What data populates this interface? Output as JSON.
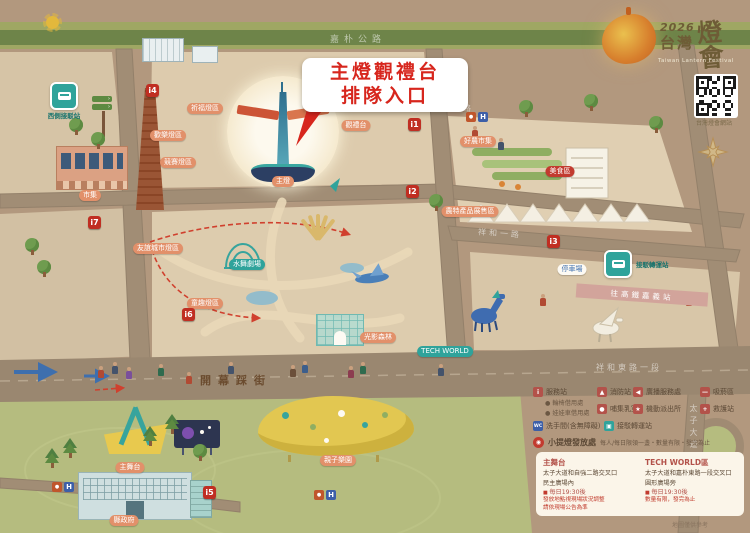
{
  "logo": {
    "year": "2026",
    "title_zh": "台灣",
    "title_cal": "燈會",
    "title_en": "Taiwan Lantern Festival",
    "qr_caption": "台灣燈會網站"
  },
  "callout": {
    "line1": "主燈觀禮台",
    "line2": "排隊入口"
  },
  "roads": {
    "top": "嘉朴公路",
    "market_top": "祥和二路",
    "market_bottom": "祥和一路",
    "east": "祥和東路一段",
    "parade": "開幕踩街",
    "south": "太子大道"
  },
  "badges": {
    "west_shuttle": "西側接駁站",
    "east_shuttle": "接駁轉運站",
    "hsr": "往高鐵嘉義站"
  },
  "markers": [
    {
      "id": "i1",
      "x": 408,
      "y": 118
    },
    {
      "id": "i2",
      "x": 406,
      "y": 185
    },
    {
      "id": "i3",
      "x": 547,
      "y": 235
    },
    {
      "id": "i4",
      "x": 146,
      "y": 84
    },
    {
      "id": "i5",
      "x": 203,
      "y": 486
    },
    {
      "id": "i6",
      "x": 182,
      "y": 308
    },
    {
      "id": "i7",
      "x": 88,
      "y": 216
    }
  ],
  "h_badges": [
    {
      "x": 466,
      "y": 112
    },
    {
      "x": 52,
      "y": 482
    },
    {
      "x": 314,
      "y": 490
    }
  ],
  "zones": [
    {
      "label": "祈福燈區",
      "x": 205,
      "y": 103,
      "c": "orange"
    },
    {
      "label": "歡樂燈區",
      "x": 168,
      "y": 130,
      "c": "orange"
    },
    {
      "label": "競賽燈區",
      "x": 178,
      "y": 157,
      "c": "orange"
    },
    {
      "label": "友誼城市燈區",
      "x": 158,
      "y": 243,
      "c": "orange"
    },
    {
      "label": "童趣燈區",
      "x": 205,
      "y": 298,
      "c": "orange"
    },
    {
      "label": "水舞劇場",
      "x": 247,
      "y": 259,
      "c": "teal"
    },
    {
      "label": "光影森林",
      "x": 378,
      "y": 332,
      "c": "orange"
    },
    {
      "label": "TECH WORLD",
      "x": 445,
      "y": 346,
      "c": "teal"
    },
    {
      "label": "好農市集",
      "x": 478,
      "y": 136,
      "c": "orange"
    },
    {
      "label": "農特產品展售區",
      "x": 470,
      "y": 206,
      "c": "orange"
    },
    {
      "label": "美食區",
      "x": 560,
      "y": 166,
      "c": "red"
    },
    {
      "label": "觀禮台",
      "x": 356,
      "y": 120,
      "c": "orange"
    },
    {
      "label": "主燈",
      "x": 283,
      "y": 176,
      "c": "orange"
    },
    {
      "label": "主舞台",
      "x": 130,
      "y": 462,
      "c": "orange"
    },
    {
      "label": "縣政府",
      "x": 124,
      "y": 515,
      "c": "orange"
    },
    {
      "label": "市集",
      "x": 90,
      "y": 190,
      "c": "orange"
    },
    {
      "label": "親子樂園",
      "x": 338,
      "y": 455,
      "c": "orange"
    },
    {
      "label": "停車場",
      "x": 572,
      "y": 264,
      "c": "white"
    }
  ],
  "legend": {
    "items": [
      {
        "label": "服務站",
        "glyph": "i",
        "color": "#b3524a",
        "x": 533,
        "y": 387,
        "sub": [
          "● 輪椅借用處",
          "● 娃娃車借用處"
        ]
      },
      {
        "label": "消防站",
        "glyph": "▲",
        "color": "#b3524a",
        "x": 597,
        "y": 387
      },
      {
        "label": "廣播服務處",
        "glyph": "◀",
        "color": "#b3524a",
        "x": 633,
        "y": 387
      },
      {
        "label": "吸菸區",
        "glyph": "—",
        "color": "#b3524a",
        "x": 700,
        "y": 387
      },
      {
        "label": "哺集乳室",
        "glyph": "●",
        "color": "#b3524a",
        "x": 597,
        "y": 404
      },
      {
        "label": "機動派出所",
        "glyph": "★",
        "color": "#b3524a",
        "x": 633,
        "y": 404
      },
      {
        "label": "救護站",
        "glyph": "+",
        "color": "#b3524a",
        "x": 700,
        "y": 404
      },
      {
        "label": "洗手間(含無障礙)",
        "glyph": "WC",
        "color": "#3d5fa8",
        "x": 533,
        "y": 421
      },
      {
        "label": "接駁轉運站",
        "glyph": "▣",
        "color": "#2fa39b",
        "x": 604,
        "y": 421
      }
    ],
    "lantern": {
      "label": "小提燈發放處",
      "note": "每人/每日限領一盞・數量有限・發完為止"
    }
  },
  "info_box": {
    "left": {
      "title": "主舞台",
      "lines": [
        "太子大道和自強二路交叉口",
        "民主廣場內"
      ],
      "time": "每日19:30後",
      "notes": [
        "發放地點視現場狀況調整",
        "請依現場公告為準"
      ]
    },
    "right": {
      "title": "TECH WORLD區",
      "lines": [
        "太子大道和嘉朴東路一段交叉口",
        "圓形廣場旁"
      ],
      "time": "每日19:30後",
      "notes": [
        "數量有限，發完為止"
      ]
    }
  },
  "footnote": "地圖僅供參考",
  "trees": [
    {
      "x": 68,
      "y": 118,
      "t": "round"
    },
    {
      "x": 90,
      "y": 132,
      "t": "round"
    },
    {
      "x": 24,
      "y": 238,
      "t": "round"
    },
    {
      "x": 36,
      "y": 260,
      "t": "round"
    },
    {
      "x": 428,
      "y": 194,
      "t": "round"
    },
    {
      "x": 518,
      "y": 100,
      "t": "round"
    },
    {
      "x": 648,
      "y": 116,
      "t": "round"
    },
    {
      "x": 583,
      "y": 94,
      "t": "round"
    },
    {
      "x": 44,
      "y": 448,
      "t": "pine"
    },
    {
      "x": 62,
      "y": 438,
      "t": "pine"
    },
    {
      "x": 142,
      "y": 426,
      "t": "pine"
    },
    {
      "x": 164,
      "y": 414,
      "t": "pine"
    },
    {
      "x": 192,
      "y": 444,
      "t": "round"
    }
  ],
  "people": [
    {
      "x": 98,
      "y": 366,
      "c": "#b14a33"
    },
    {
      "x": 112,
      "y": 362,
      "c": "#44536b"
    },
    {
      "x": 126,
      "y": 367,
      "c": "#7a4f9b"
    },
    {
      "x": 158,
      "y": 364,
      "c": "#2f6b4e"
    },
    {
      "x": 186,
      "y": 372,
      "c": "#b14a33"
    },
    {
      "x": 228,
      "y": 362,
      "c": "#44536b"
    },
    {
      "x": 290,
      "y": 365,
      "c": "#6b4f3a"
    },
    {
      "x": 302,
      "y": 361,
      "c": "#3c5e8c"
    },
    {
      "x": 348,
      "y": 366,
      "c": "#8c3c50"
    },
    {
      "x": 360,
      "y": 362,
      "c": "#2f6b4e"
    },
    {
      "x": 438,
      "y": 364,
      "c": "#44536b"
    },
    {
      "x": 540,
      "y": 294,
      "c": "#b14a33"
    },
    {
      "x": 686,
      "y": 294,
      "c": "#b14a33"
    },
    {
      "x": 472,
      "y": 126,
      "c": "#b14a33"
    },
    {
      "x": 498,
      "y": 138,
      "c": "#44536b"
    }
  ]
}
